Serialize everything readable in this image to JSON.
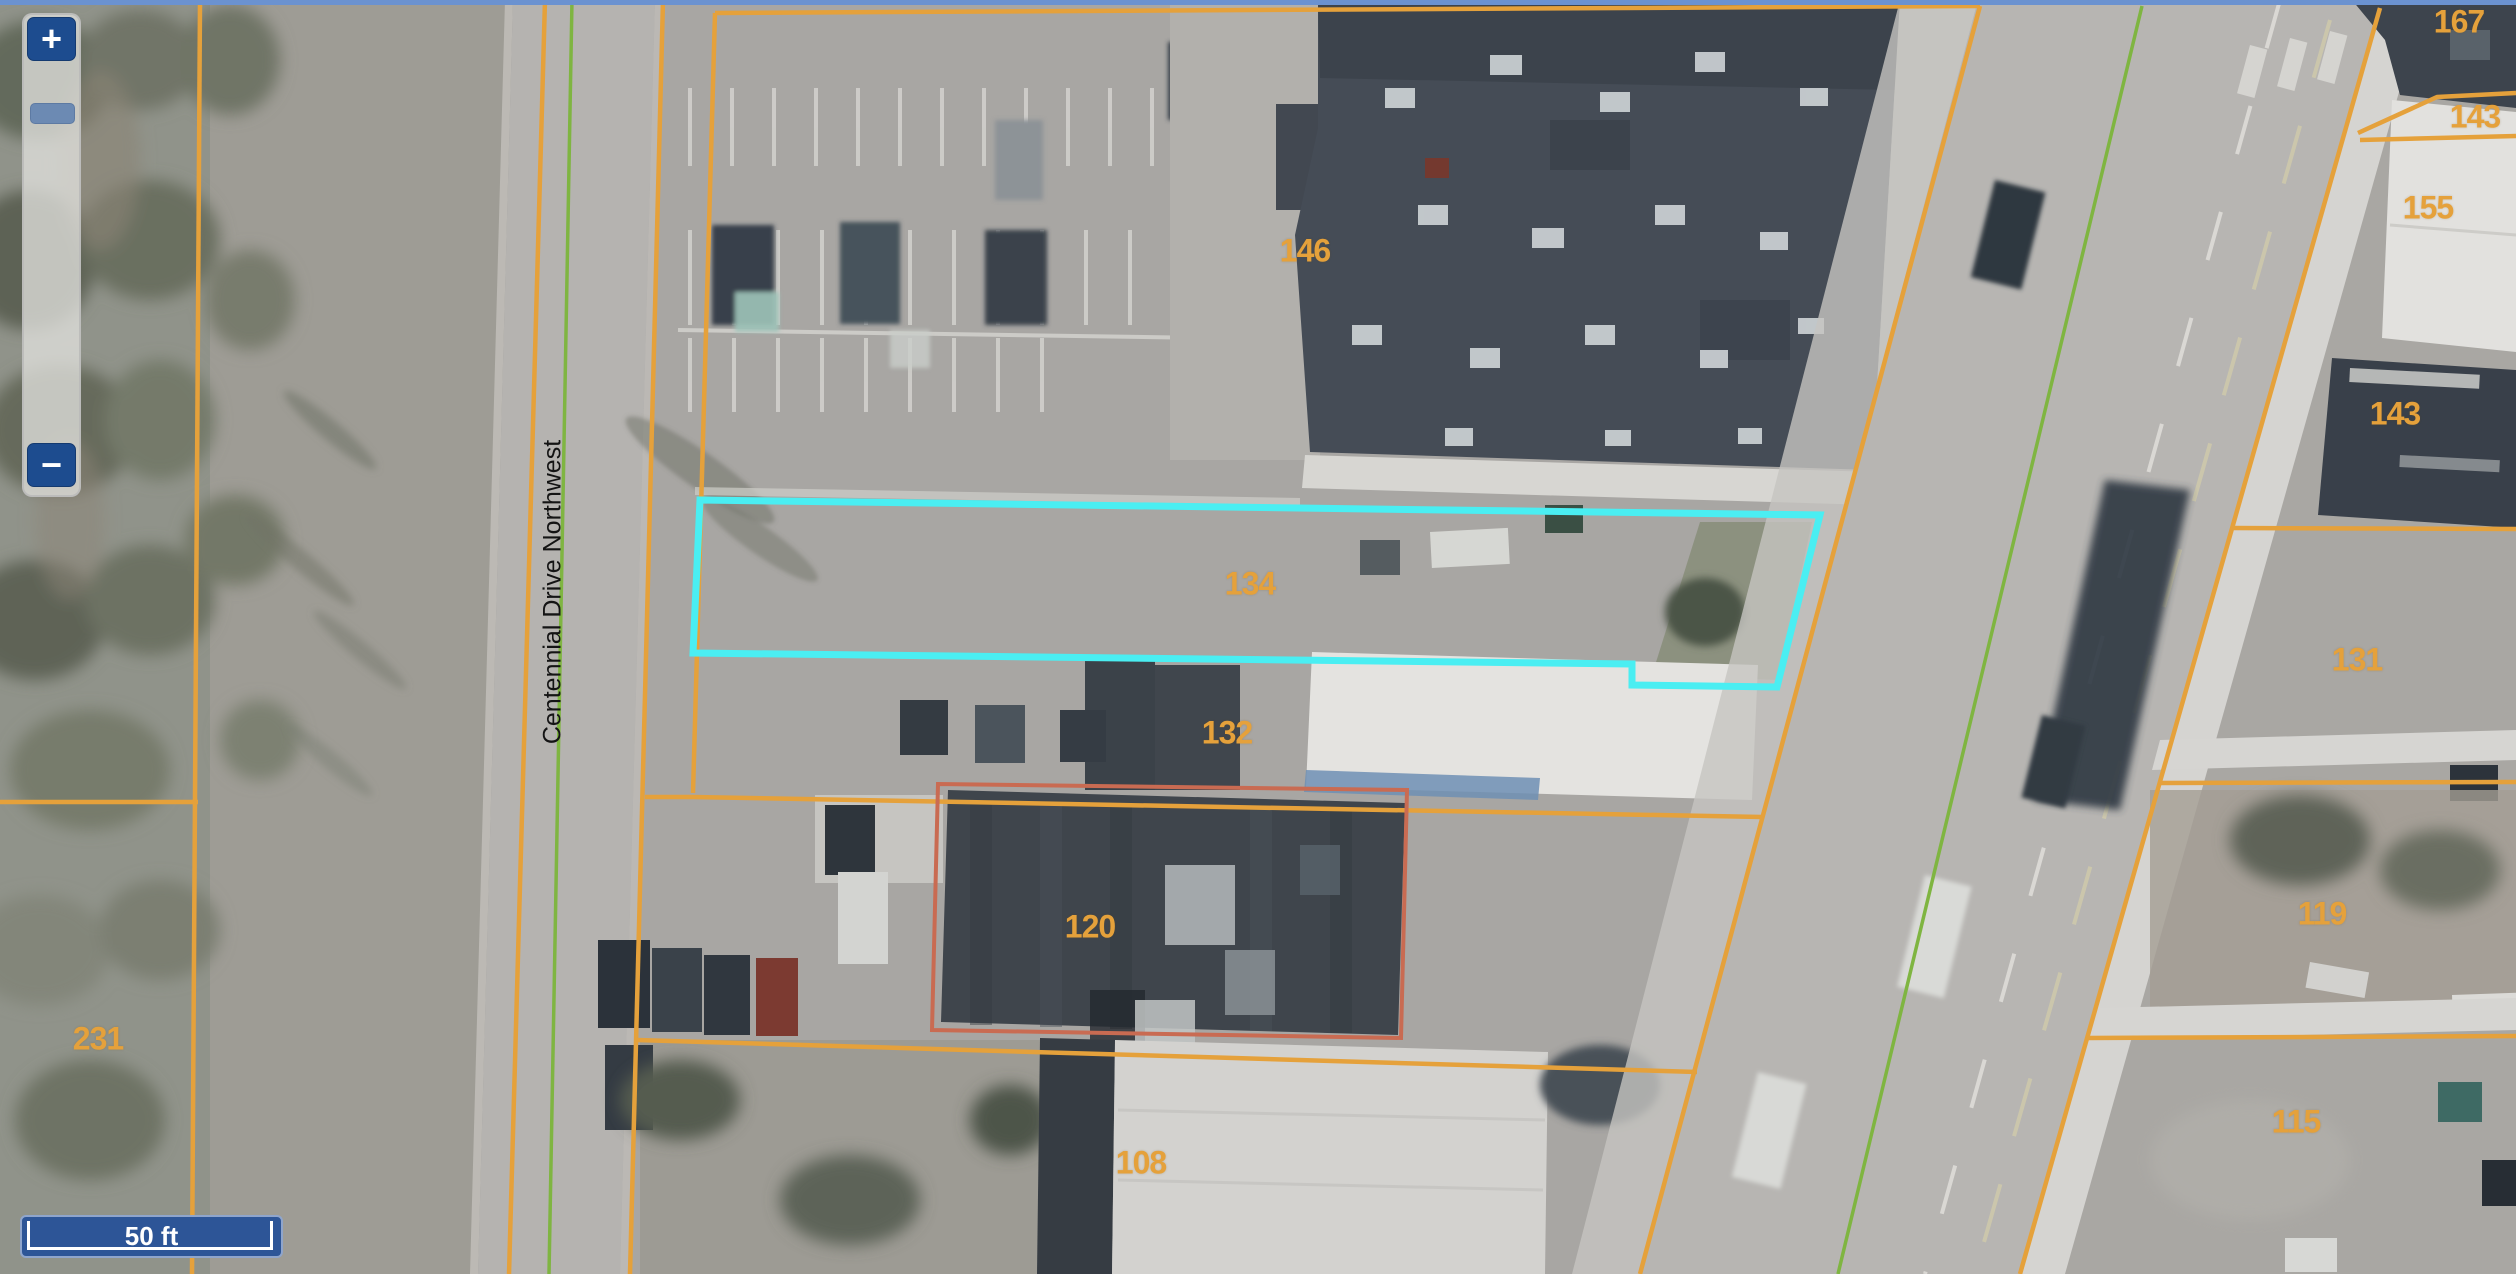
{
  "window": {
    "top_edge_color": "#6B92D0"
  },
  "controls": {
    "zoom_in_label": "+",
    "zoom_out_label": "−",
    "scale_label": "50 ft"
  },
  "map": {
    "street_label": "Centennial Drive Northwest",
    "parcels": [
      {
        "label": "146"
      },
      {
        "label": "134"
      },
      {
        "label": "132"
      },
      {
        "label": "120"
      },
      {
        "label": "108"
      },
      {
        "label": "231"
      },
      {
        "label": "167"
      },
      {
        "label": "143"
      },
      {
        "label": "155"
      },
      {
        "label": "143"
      },
      {
        "label": "131"
      },
      {
        "label": "119"
      },
      {
        "label": "115"
      }
    ],
    "colors": {
      "parcel_line": "#E5A13B",
      "highlight_outline": "#4AEEF2",
      "selected_parcel_outline": "#C96B52",
      "road_centerline": "#7FB541"
    }
  }
}
